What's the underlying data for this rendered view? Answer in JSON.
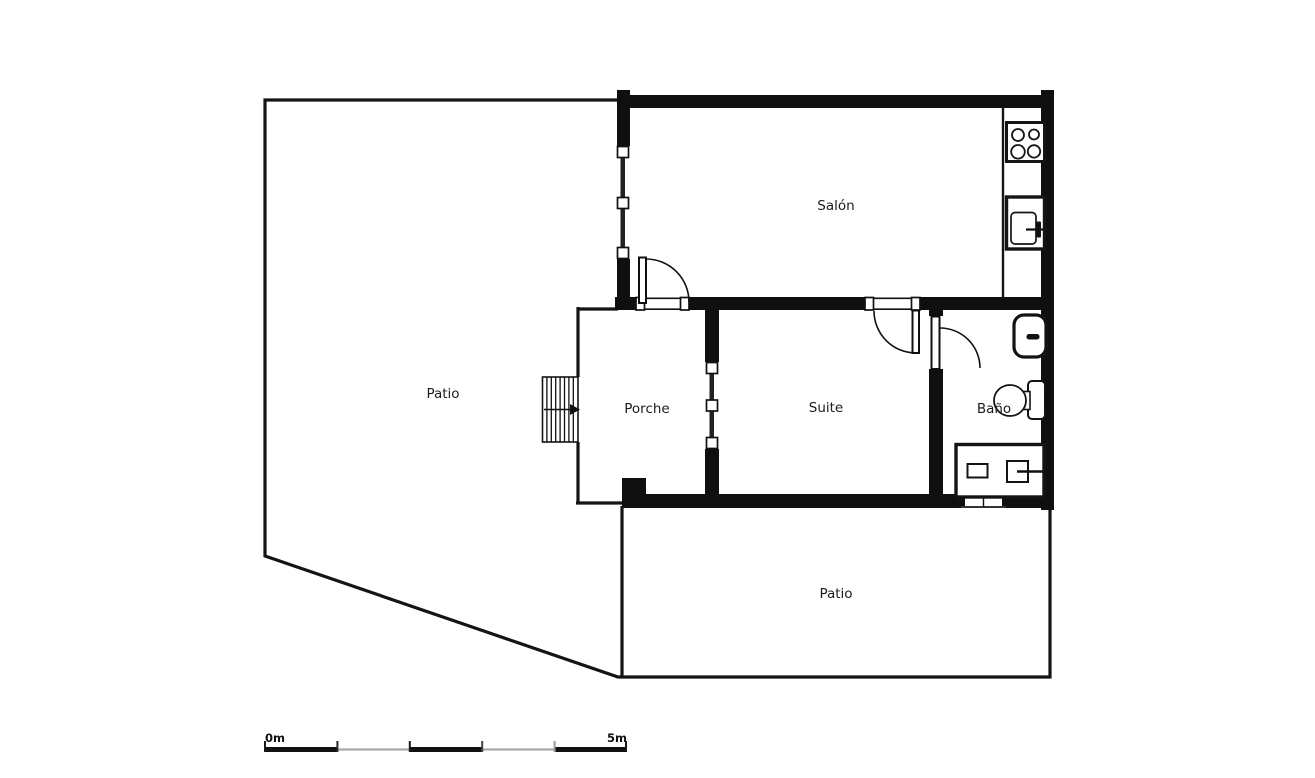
{
  "document": {
    "type": "floor-plan"
  },
  "rooms": [
    {
      "id": "salon",
      "label": "Salón"
    },
    {
      "id": "patio-left",
      "label": "Patio"
    },
    {
      "id": "porche",
      "label": "Porche"
    },
    {
      "id": "suite",
      "label": "Suite"
    },
    {
      "id": "bano",
      "label": "Baño"
    },
    {
      "id": "patio-bottom",
      "label": "Patio"
    }
  ],
  "scale_bar": {
    "start_label": "0m",
    "end_label": "5m",
    "meters": 5,
    "segments": 5
  },
  "fixtures": [
    "stove-icon",
    "kitchen-sink-icon",
    "bathroom-sink-icon",
    "toilet-icon",
    "shower-icon",
    "stairs-icon",
    "entry-arrow-icon",
    "door-swing-icon",
    "window-icon"
  ],
  "colors": {
    "bg": "#ffffff",
    "floor": "#f4f4f4",
    "wall": "#0f0f0f",
    "line": "#141414",
    "text": "#1c1c1c",
    "scale-gray": "#a8a8a8"
  }
}
